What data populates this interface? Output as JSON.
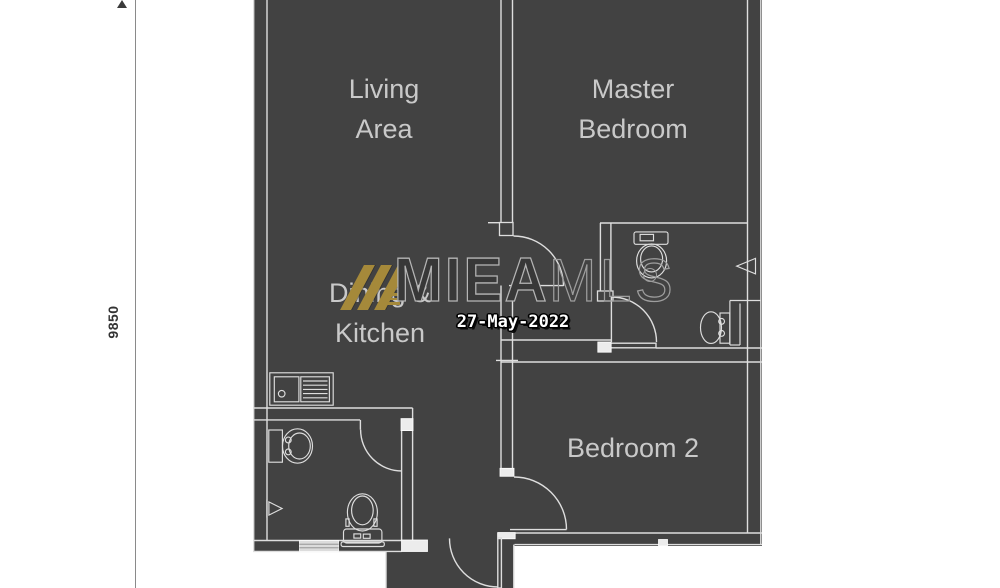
{
  "dimension": {
    "value": "9850"
  },
  "rooms": {
    "living": {
      "line1": "Living",
      "line2": "Area"
    },
    "master": {
      "line1": "Master",
      "line2": "Bedroom"
    },
    "dining": {
      "line1": "Dining &",
      "line2": "Kitchen"
    },
    "bedroom2": {
      "label": "Bedroom 2"
    }
  },
  "watermark": {
    "brand_primary": "MIEA",
    "brand_secondary": "MLS",
    "date": "27-May-2022"
  },
  "icons": [
    "kitchen-sink",
    "wash-basin",
    "shower-head",
    "toilet",
    "vanity-basin",
    "door-swing",
    "window",
    "dimension-arrow",
    "brand-slashes"
  ],
  "colors": {
    "plan_bg": "#424242",
    "wall_line": "#dedede",
    "label_text": "#c9c9c9",
    "logo_gold": "#a5893a",
    "dimension_line": "#8a8a8a",
    "dimension_text": "#333333",
    "watermark_fill": "#383838",
    "watermark_stroke": "#b5b5b5",
    "date_text": "#ffffff"
  }
}
